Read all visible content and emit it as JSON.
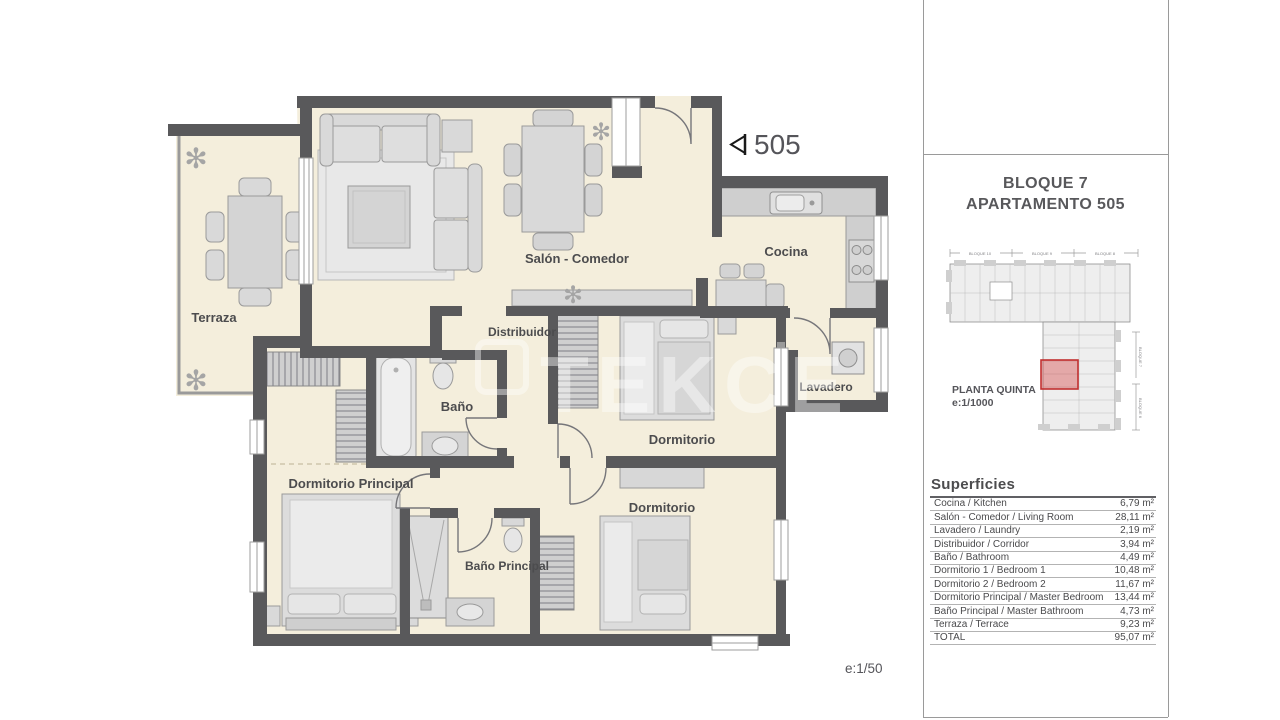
{
  "plan": {
    "unit_label": "505",
    "scale": "e:1/50",
    "watermark": "TEKCE",
    "rooms": {
      "terraza": "Terraza",
      "salon": "Salón - Comedor",
      "cocina": "Cocina",
      "distribuidor": "Distribuidor",
      "lavadero": "Lavadero",
      "bano": "Baño",
      "dormitorio1": "Dormitorio",
      "dormitorio2": "Dormitorio",
      "dormitorio_principal": "Dormitorio Principal",
      "bano_principal": "Baño Principal"
    }
  },
  "sidebar": {
    "title_line1": "BLOQUE 7",
    "title_line2": "APARTAMENTO 505",
    "site_plan": {
      "caption_line1": "PLANTA QUINTA",
      "caption_line2": "e:1/1000",
      "block_labels": [
        "BLOQUE 10",
        "BLOQUE 9",
        "BLOQUE 8"
      ],
      "side_labels": [
        "BLOQUE 7",
        "BLOQUE 6"
      ],
      "highlight_color": "#c23030"
    },
    "table": {
      "heading": "Superficies",
      "unit_suffix": "m²",
      "rows": [
        {
          "label": "Cocina / Kitchen",
          "value": "6,79"
        },
        {
          "label": "Salón - Comedor / Living Room",
          "value": "28,11"
        },
        {
          "label": "Lavadero / Laundry",
          "value": "2,19"
        },
        {
          "label": "Distribuidor / Corridor",
          "value": "3,94"
        },
        {
          "label": "Baño / Bathroom",
          "value": "4,49"
        },
        {
          "label": "Dormitorio 1 / Bedroom 1",
          "value": "10,48"
        },
        {
          "label": "Dormitorio 2 / Bedroom 2",
          "value": "11,67"
        },
        {
          "label": "Dormitorio Principal / Master Bedroom",
          "value": "13,44"
        },
        {
          "label": "Baño Principal / Master Bathroom",
          "value": "4,73"
        },
        {
          "label": "Terraza / Terrace",
          "value": "9,23"
        },
        {
          "label": "TOTAL",
          "value": "95,07"
        }
      ]
    }
  },
  "colors": {
    "wall": "#59595b",
    "floor": "#f4eedc",
    "furniture": "#d9d9d9",
    "highlight_red": "#c23030",
    "watermark_white": "#ffffff"
  }
}
